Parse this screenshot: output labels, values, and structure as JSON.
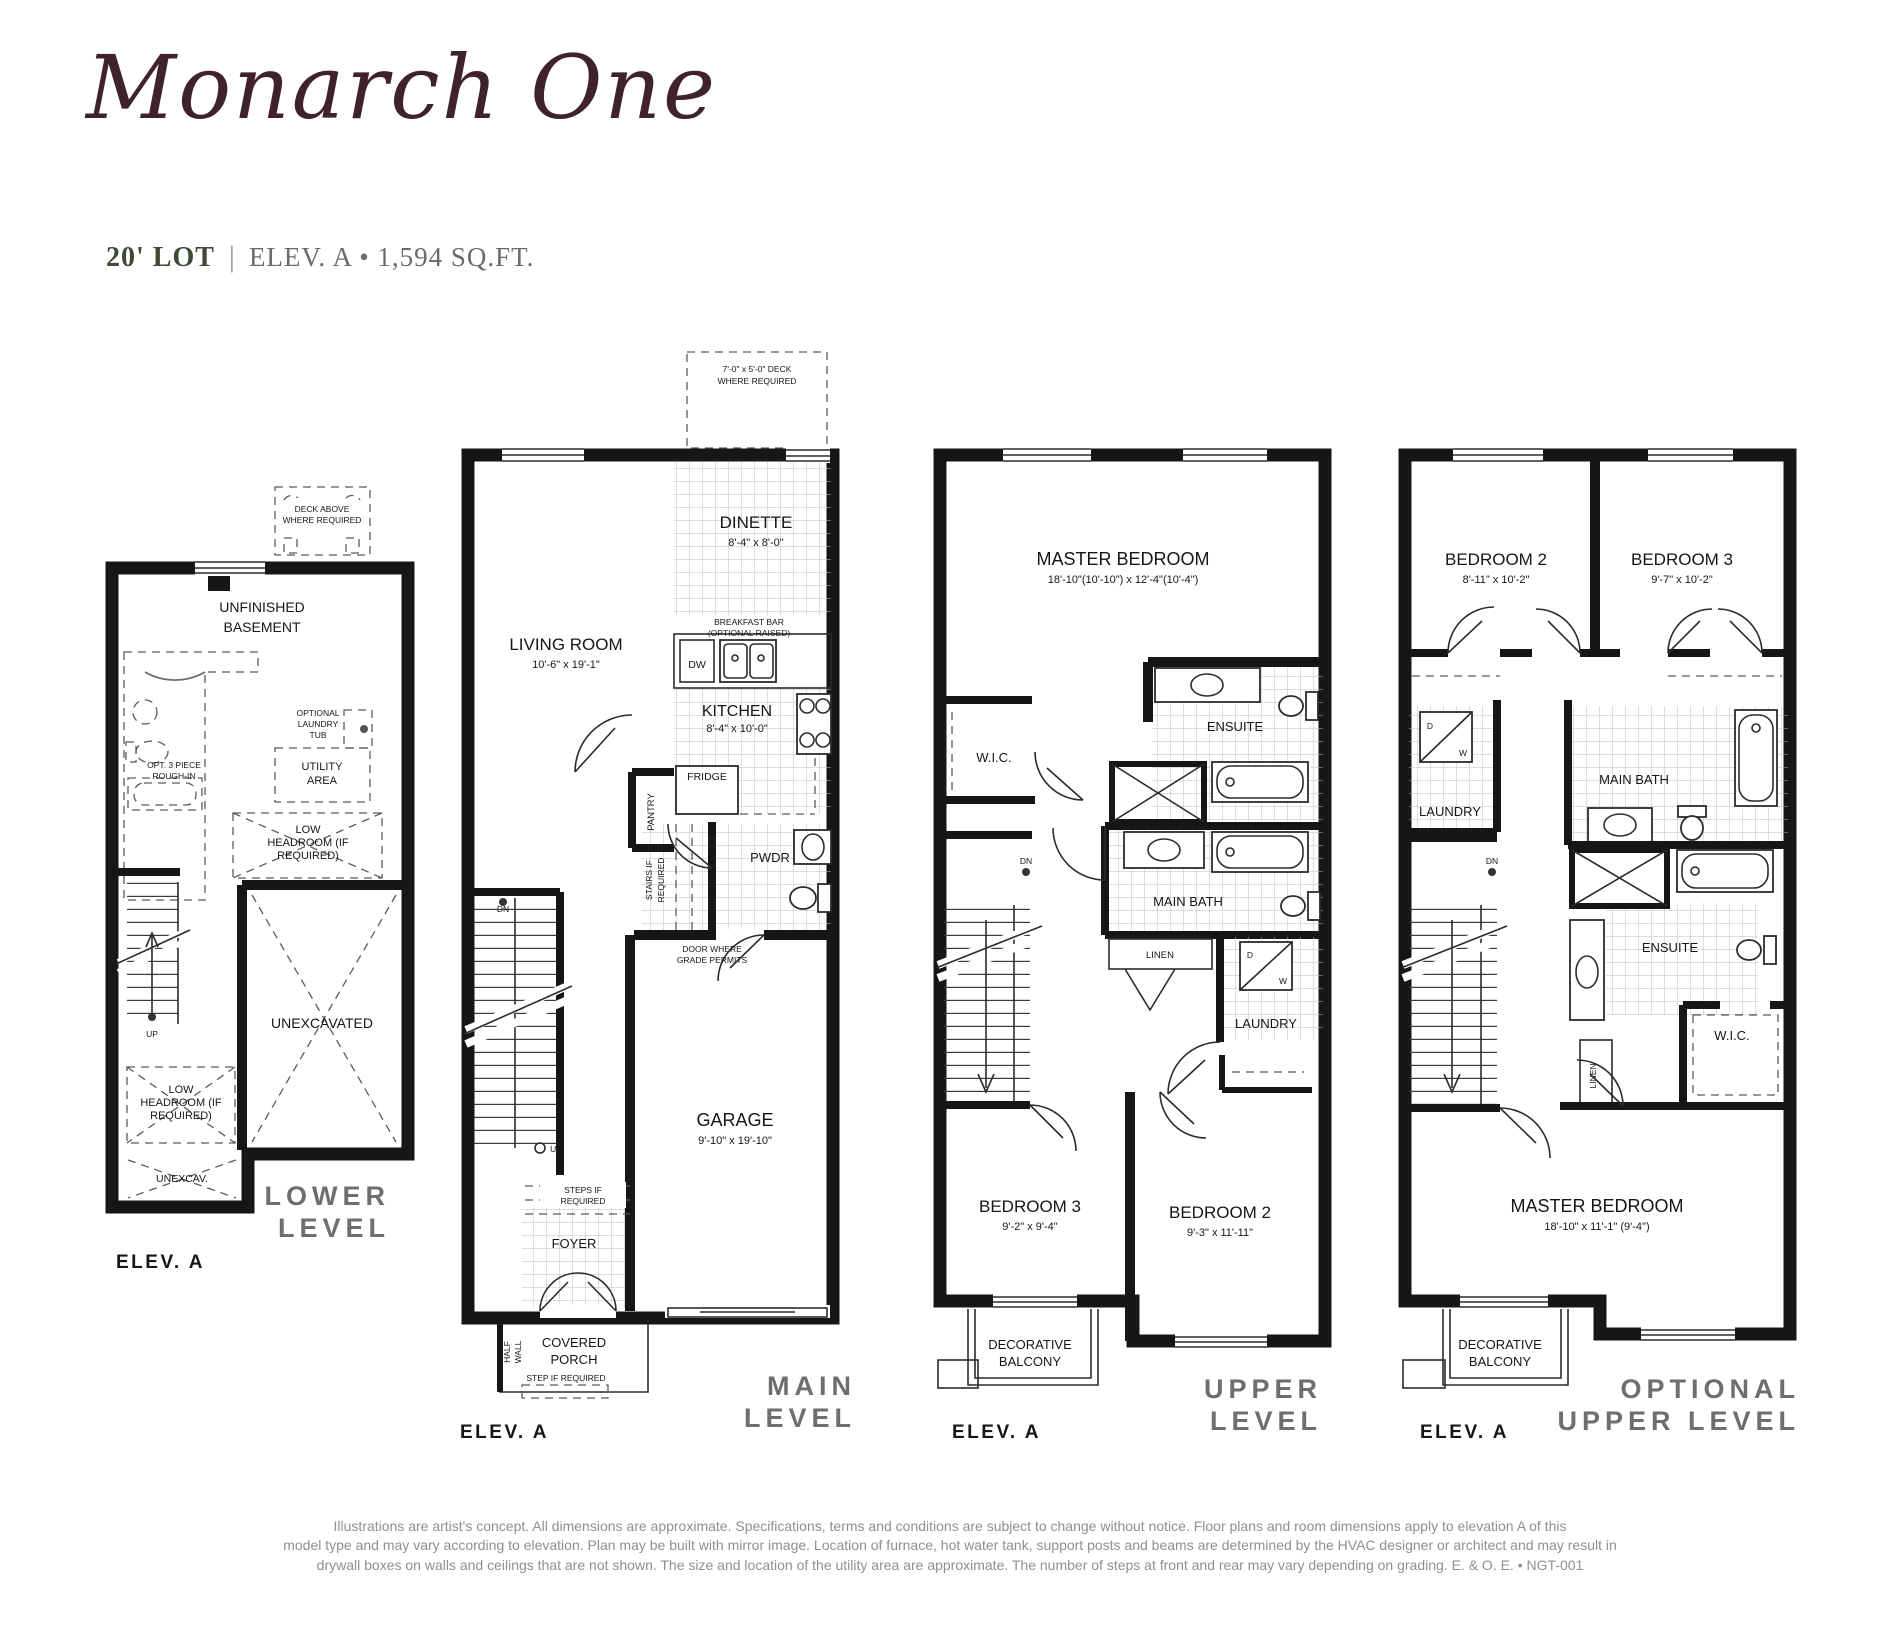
{
  "header": {
    "title": "Monarch One",
    "lot": "20' LOT",
    "divider": "|",
    "info": "ELEV. A • 1,594 SQ.FT."
  },
  "lower": {
    "deck_above": [
      "DECK ABOVE",
      "WHERE REQUIRED"
    ],
    "room": [
      "UNFINISHED",
      "BASEMENT"
    ],
    "rough_in": [
      "OPT. 3 PIECE",
      "ROUGH-IN"
    ],
    "laundry_tub": [
      "OPTIONAL",
      "LAUNDRY",
      "TUB"
    ],
    "utility": [
      "UTILITY",
      "AREA"
    ],
    "low_headroom": [
      "LOW",
      "HEADROOM (IF",
      "REQUIRED)"
    ],
    "unexcavated": "UNEXCAVATED",
    "unexcav": "UNEXCAV.",
    "up": "UP",
    "level": [
      "LOWER",
      "LEVEL"
    ],
    "elev": "ELEV. A"
  },
  "main": {
    "deck": [
      "7'-0\" x 5'-0\" DECK",
      "WHERE REQUIRED"
    ],
    "dinette": {
      "name": "DINETTE",
      "dims": "8'-4\" x 8'-0\""
    },
    "living": {
      "name": "LIVING ROOM",
      "dims": "10'-6\" x 19'-1\""
    },
    "breakfast": [
      "BREAKFAST BAR",
      "(OPTIONAL RAISED)"
    ],
    "dw": "DW",
    "kitchen": {
      "name": "KITCHEN",
      "dims": "8'-4\" x 10'-0\""
    },
    "fridge": "FRIDGE",
    "pantry": "PANTRY",
    "pwdr": "PWDR",
    "stairs_if": [
      "STAIRS IF",
      "REQUIRED"
    ],
    "door_grade": [
      "DOOR WHERE",
      "GRADE PERMITS"
    ],
    "dn": "DN",
    "up": "UP",
    "garage": {
      "name": "GARAGE",
      "dims": "9'-10\" x 19'-10\""
    },
    "steps_if": [
      "STEPS IF",
      "REQUIRED"
    ],
    "foyer": "FOYER",
    "half_wall": [
      "HALF",
      "WALL"
    ],
    "porch": [
      "COVERED",
      "PORCH"
    ],
    "step_if": "STEP IF REQUIRED",
    "level": [
      "MAIN",
      "LEVEL"
    ],
    "elev": "ELEV. A"
  },
  "upper": {
    "master": {
      "name": "MASTER BEDROOM",
      "dims": "18'-10\"(10'-10\") x 12'-4\"(10'-4\")"
    },
    "wic": "W.I.C.",
    "ensuite": "ENSUITE",
    "main_bath": "MAIN BATH",
    "linen": "LINEN",
    "laundry": "LAUNDRY",
    "d": "D",
    "w": "W",
    "dn": "DN",
    "bed3": {
      "name": "BEDROOM 3",
      "dims": "9'-2\" x 9'-4\""
    },
    "bed2": {
      "name": "BEDROOM 2",
      "dims": "9'-3\" x 11'-11\""
    },
    "balcony": [
      "DECORATIVE",
      "BALCONY"
    ],
    "level": [
      "UPPER",
      "LEVEL"
    ],
    "elev": "ELEV. A"
  },
  "optional": {
    "bed2": {
      "name": "BEDROOM 2",
      "dims": "8'-11\" x 10'-2\""
    },
    "bed3": {
      "name": "BEDROOM 3",
      "dims": "9'-7\" x 10'-2\""
    },
    "laundry": "LAUNDRY",
    "d": "D",
    "w": "W",
    "main_bath": "MAIN BATH",
    "ensuite": "ENSUITE",
    "wic": "W.I.C.",
    "linen": "LINEN",
    "dn": "DN",
    "master": {
      "name": "MASTER BEDROOM",
      "dims": "18'-10\" x 11'-1\" (9'-4\")"
    },
    "balcony": [
      "DECORATIVE",
      "BALCONY"
    ],
    "level": [
      "OPTIONAL",
      "UPPER LEVEL"
    ],
    "elev": "ELEV. A"
  },
  "disclaimer": [
    "Illustrations are artist's concept. All dimensions are approximate. Specifications, terms and conditions are subject to change without notice. Floor plans and room dimensions apply to elevation A of this",
    "model type and may vary according to elevation. Plan may be built with mirror image. Location of furnace, hot water tank, support posts and beams are determined by the HVAC designer or architect and may result in",
    "drywall boxes on walls and ceilings that are not shown. The size and location of the utility area are approximate. The number of steps at front and rear may vary depending on grading. E. & O. E. • NGT-001"
  ]
}
